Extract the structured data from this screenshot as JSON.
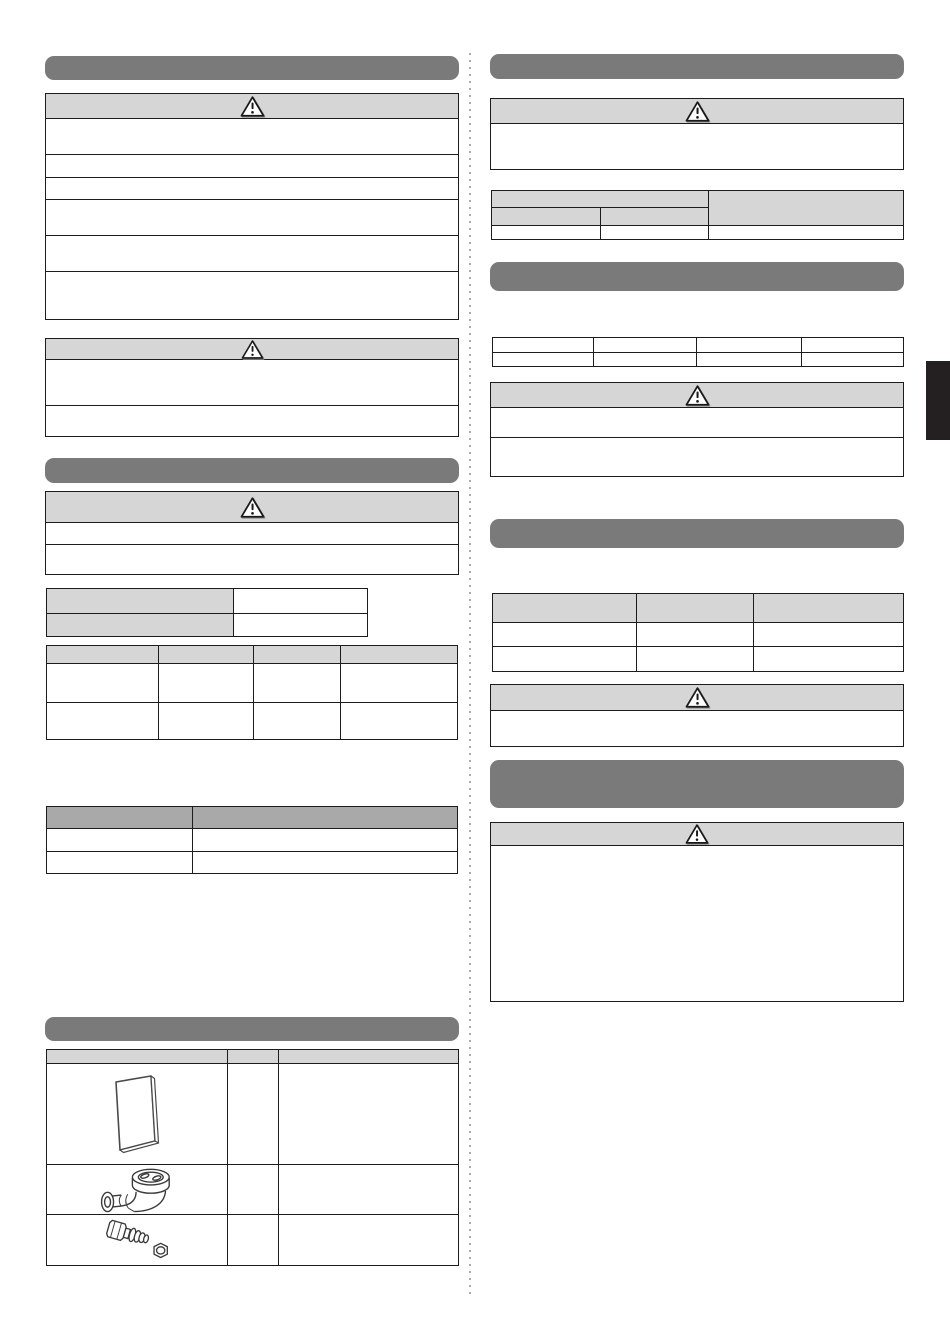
{
  "document": {
    "kind": "installation-manual-page",
    "page_text_visible": false
  },
  "colors": {
    "page_bg": "#ffffff",
    "section_bar": "#7a7a7a",
    "box_header_bg": "#d6d6d6",
    "table_header_light_bg": "#d6d6d6",
    "table_header_dark_bg": "#a9a9a9",
    "border": "#1c1c1c",
    "side_tab": "#242021",
    "divider_dots": "#ababab"
  },
  "icons": {
    "warning_triangle": "warning-triangle-icon",
    "accessory_images": [
      "manual-booklet-image",
      "drain-elbow-image",
      "pipe-fitting-image"
    ]
  },
  "left_column": {
    "section_bar_1": {
      "title": ""
    },
    "warning_box_1": {
      "header_label": "",
      "rows": [
        "",
        "",
        "",
        "",
        "",
        ""
      ]
    },
    "warning_box_2": {
      "header_label": "",
      "rows": [
        "",
        ""
      ]
    },
    "section_bar_2": {
      "title": ""
    },
    "warning_box_3": {
      "header_label": "",
      "rows": [
        "",
        ""
      ]
    },
    "pair_table": {
      "rows": [
        {
          "label": "",
          "value": ""
        },
        {
          "label": "",
          "value": ""
        }
      ]
    },
    "four_col_table": {
      "headers": [
        "",
        "",
        "",
        ""
      ],
      "rows": [
        [
          "",
          "",
          "",
          ""
        ],
        [
          "",
          "",
          "",
          ""
        ]
      ]
    },
    "two_col_table": {
      "headers": [
        "",
        ""
      ],
      "rows": [
        [
          "",
          ""
        ],
        [
          "",
          ""
        ]
      ]
    },
    "section_bar_3": {
      "title": ""
    },
    "accessories_table": {
      "headers": [
        "",
        "",
        ""
      ],
      "rows": [
        {
          "image_icon": "manual-booklet-image",
          "qty": "",
          "description": ""
        },
        {
          "image_icon": "drain-elbow-image",
          "qty": "",
          "description": ""
        },
        {
          "image_icon": "pipe-fitting-image",
          "qty": "",
          "description": ""
        }
      ]
    }
  },
  "right_column": {
    "section_bar_1": {
      "title": ""
    },
    "warning_box_1": {
      "header_label": "",
      "rows": [
        ""
      ]
    },
    "merged_header_table": {
      "group_header": "",
      "rowspan_header": "",
      "sub_headers": [
        "",
        ""
      ],
      "row": [
        "",
        "",
        ""
      ]
    },
    "section_bar_2": {
      "title": ""
    },
    "four_col_table": {
      "rows": [
        [
          "",
          "",
          "",
          ""
        ],
        [
          "",
          "",
          "",
          ""
        ]
      ]
    },
    "warning_box_2": {
      "header_label": "",
      "rows": [
        "",
        ""
      ]
    },
    "section_bar_3": {
      "title": ""
    },
    "three_col_table": {
      "headers": [
        "",
        "",
        ""
      ],
      "rows": [
        [
          "",
          "",
          ""
        ],
        [
          "",
          "",
          ""
        ]
      ]
    },
    "warning_box_3": {
      "header_label": "",
      "rows": [
        ""
      ]
    },
    "section_bar_4": {
      "title": ""
    },
    "warning_box_4": {
      "header_label": "",
      "rows": [
        ""
      ]
    }
  },
  "side_tab": {
    "label": ""
  }
}
